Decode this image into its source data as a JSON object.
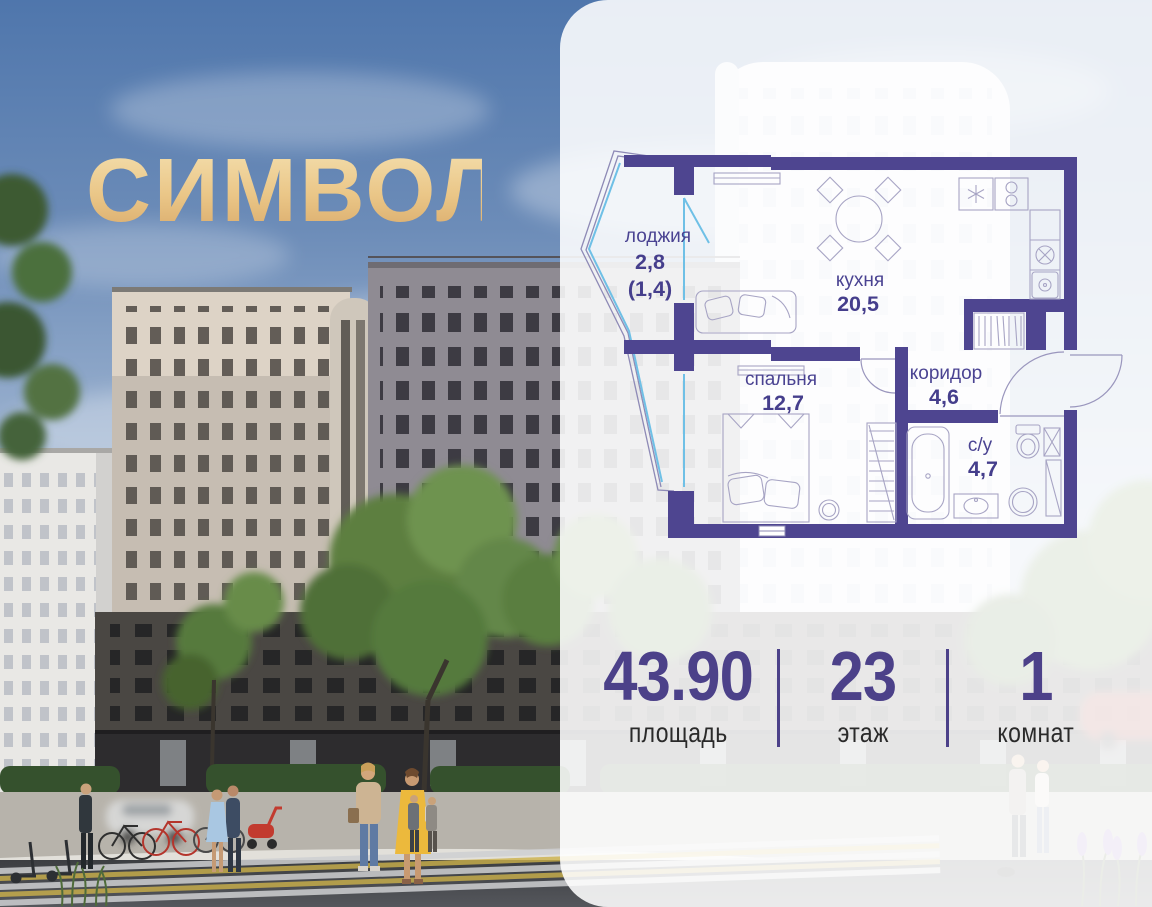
{
  "logo": {
    "text": "СИМВОЛ",
    "color": "#eac687"
  },
  "floor_plan": {
    "wall_color": "#4e4590",
    "glazing_color": "#6fc0e6",
    "label_color": "#453e8c",
    "rooms": [
      {
        "id": "loggia",
        "name": "лоджия",
        "area": "2,8",
        "area_note": "(1,4)"
      },
      {
        "id": "kitchen",
        "name": "кухня",
        "area": "20,5"
      },
      {
        "id": "bedroom",
        "name": "спальня",
        "area": "12,7"
      },
      {
        "id": "corridor",
        "name": "коридор",
        "area": "4,6"
      },
      {
        "id": "bathroom",
        "name": "с/у",
        "area": "4,7"
      }
    ],
    "icons": [
      "fridge-icon",
      "stove-icon",
      "kitchen-sink-icon",
      "washer-icon",
      "dining-table-icon",
      "sofa-icon",
      "wardrobe-hangers-icon",
      "bed-icon",
      "pouf-icon",
      "shelving-icon",
      "bathtub-icon",
      "toilet-icon",
      "washbasin-icon",
      "door-swing-arc"
    ]
  },
  "stats": {
    "value_color": "#4c4189",
    "label_color": "#2a2a2a",
    "divider_color": "#4c4189",
    "items": [
      {
        "value": "43.90",
        "label": "площадь"
      },
      {
        "value": "23",
        "label": "этаж"
      },
      {
        "value": "1",
        "label": "комнат"
      }
    ]
  }
}
